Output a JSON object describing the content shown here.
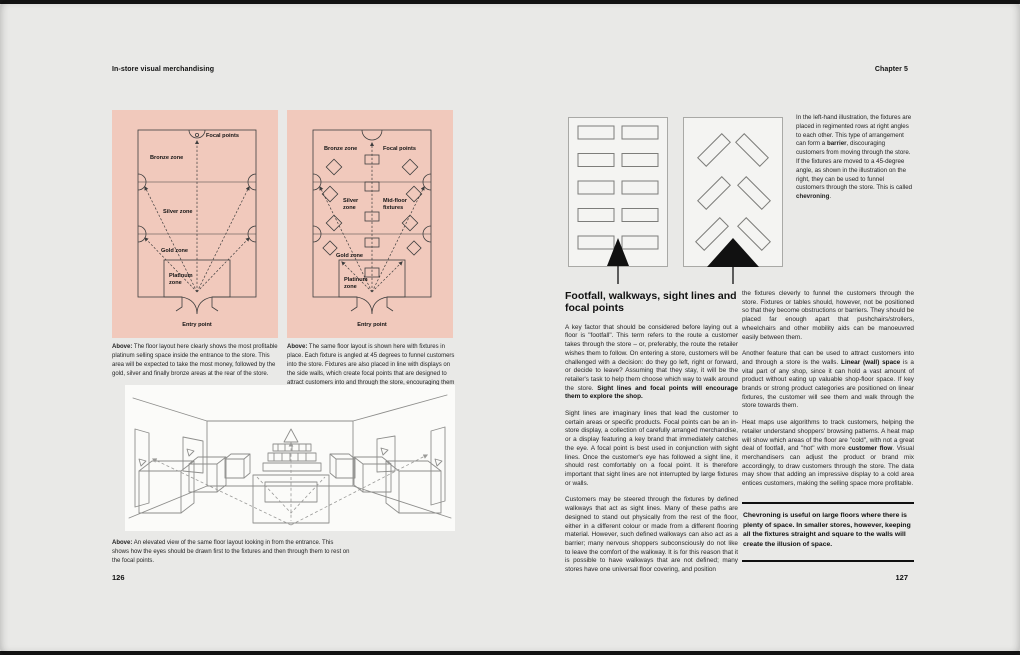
{
  "colors": {
    "page_bg": "#e9e9e7",
    "panel_pink": "#f1c9bc",
    "ink": "#141414"
  },
  "header": {
    "left_title": "In-store visual merchandising",
    "chapter": "Chapter 5"
  },
  "left_page": {
    "page_number": "126",
    "zone_diagram": {
      "focal_points": "Focal points",
      "bronze": "Bronze zone",
      "silver": "Silver zone",
      "gold": "Gold zone",
      "platinum_line1": "Platinum",
      "platinum_line2": "zone",
      "entry": "Entry point",
      "caption_label": "Above:",
      "caption": "The floor layout here clearly shows the most profitable platinum selling space inside the entrance to the store. This area will be expected to take the most money, followed by the gold, silver and finally bronze areas at the rear of the store."
    },
    "fixture_diagram": {
      "bronze": "Bronze zone",
      "focal_points": "Focal points",
      "silver_line1": "Silver",
      "silver_line2": "zone",
      "midfloor_line1": "Mid-floor",
      "midfloor_line2": "fixtures",
      "gold": "Gold zone",
      "platinum_line1": "Platinum",
      "platinum_line2": "zone",
      "entry": "Entry point",
      "caption_label": "Above:",
      "caption": "The same floor layout is shown here with fixtures in place. Each fixture is angled at 45 degrees to funnel customers into the store. Fixtures are also placed in line with displays on the side walls, which create focal points that are designed to attract customers into and through the store, encouraging them to explore the whole shop."
    },
    "sketch": {
      "caption_label": "Above:",
      "caption": "An elevated view of the same floor layout looking in from the entrance. This shows how the eyes should be drawn first to the fixtures and then through them to rest on the focal points."
    }
  },
  "right_page": {
    "page_number": "127",
    "margin_note": {
      "part1": "In the left-hand illustration, the fixtures are placed in regimented rows at right angles to each other. This type of arrangement can form a ",
      "bold1": "barrier",
      "part2": ", discouraging customers from moving through the store. If the fixtures are moved to a 45-degree angle, as shown in the illustration on the right, they can be used to funnel customers through the store. This is called ",
      "bold2": "chevroning",
      "part3": "."
    },
    "heading": "Footfall, walkways, sight lines and focal points",
    "col1": {
      "p1_text": "A key factor that should be considered before laying out a floor is \"footfall\". This term refers to the route a customer takes through the store – or, preferably, the route the retailer wishes them to follow. On entering a store, customers will be challenged with a decision: do they go left, right or forward, or decide to leave? Assuming that they stay, it will be the retailer's task to help them choose which way to walk around the store. ",
      "p1_bold": "Sight lines and focal points will encourage them to explore the shop.",
      "p2": "Sight lines are imaginary lines that lead the customer to certain areas or specific products. Focal points can be an in-store display, a collection of carefully arranged merchandise, or a display featuring a key brand that immediately catches the eye. A focal point is best used in conjunction with sight lines. Once the customer's eye has followed a sight line, it should rest comfortably on a focal point. It is therefore important that sight lines are not interrupted by large fixtures or walls.",
      "p3": "Customers may be steered through the fixtures by defined walkways that act as sight lines. Many of these paths are designed to stand out physically from the rest of the floor, either in a different colour or made from a different flooring material. However, such defined walkways can also act as a barrier; many nervous shoppers subconsciously do not like to leave the comfort of the walkway. It is for this reason that it is possible to have walkways that are not defined; many stores have one universal floor covering, and position"
    },
    "col2": {
      "p1": "the fixtures cleverly to funnel the customers through the store. Fixtures or tables should, however, not be positioned so that they become obstructions or barriers. They should be placed far enough apart that pushchairs/strollers, wheelchairs and other mobility aids can be manoeuvred easily between them.",
      "p2_text1": "Another feature that can be used to attract customers into and through a store is the walls. ",
      "p2_bold": "Linear (wall) space",
      "p2_text2": " is a vital part of any shop, since it can hold a vast amount of product without eating up valuable shop-floor space. If key brands or strong product categories are positioned on linear fixtures, the customer will see them and walk through the store towards them.",
      "p3_text1": "Heat maps use algorithms to track customers, helping the retailer understand shoppers' browsing patterns. A heat map will show which areas of the floor are \"cold\", with not a great deal of footfall, and \"hot\" with more ",
      "p3_bold": "customer flow",
      "p3_text2": ". Visual merchandisers can adjust the product or brand mix accordingly, to draw customers through the store. The data may show that adding an impressive display to a cold area entices customers, making the selling space more profitable.",
      "pull_quote": "Chevroning is useful on large floors where there is plenty of space. In smaller stores, however, keeping all the fixtures straight and square to the walls will create the illusion of space."
    }
  }
}
